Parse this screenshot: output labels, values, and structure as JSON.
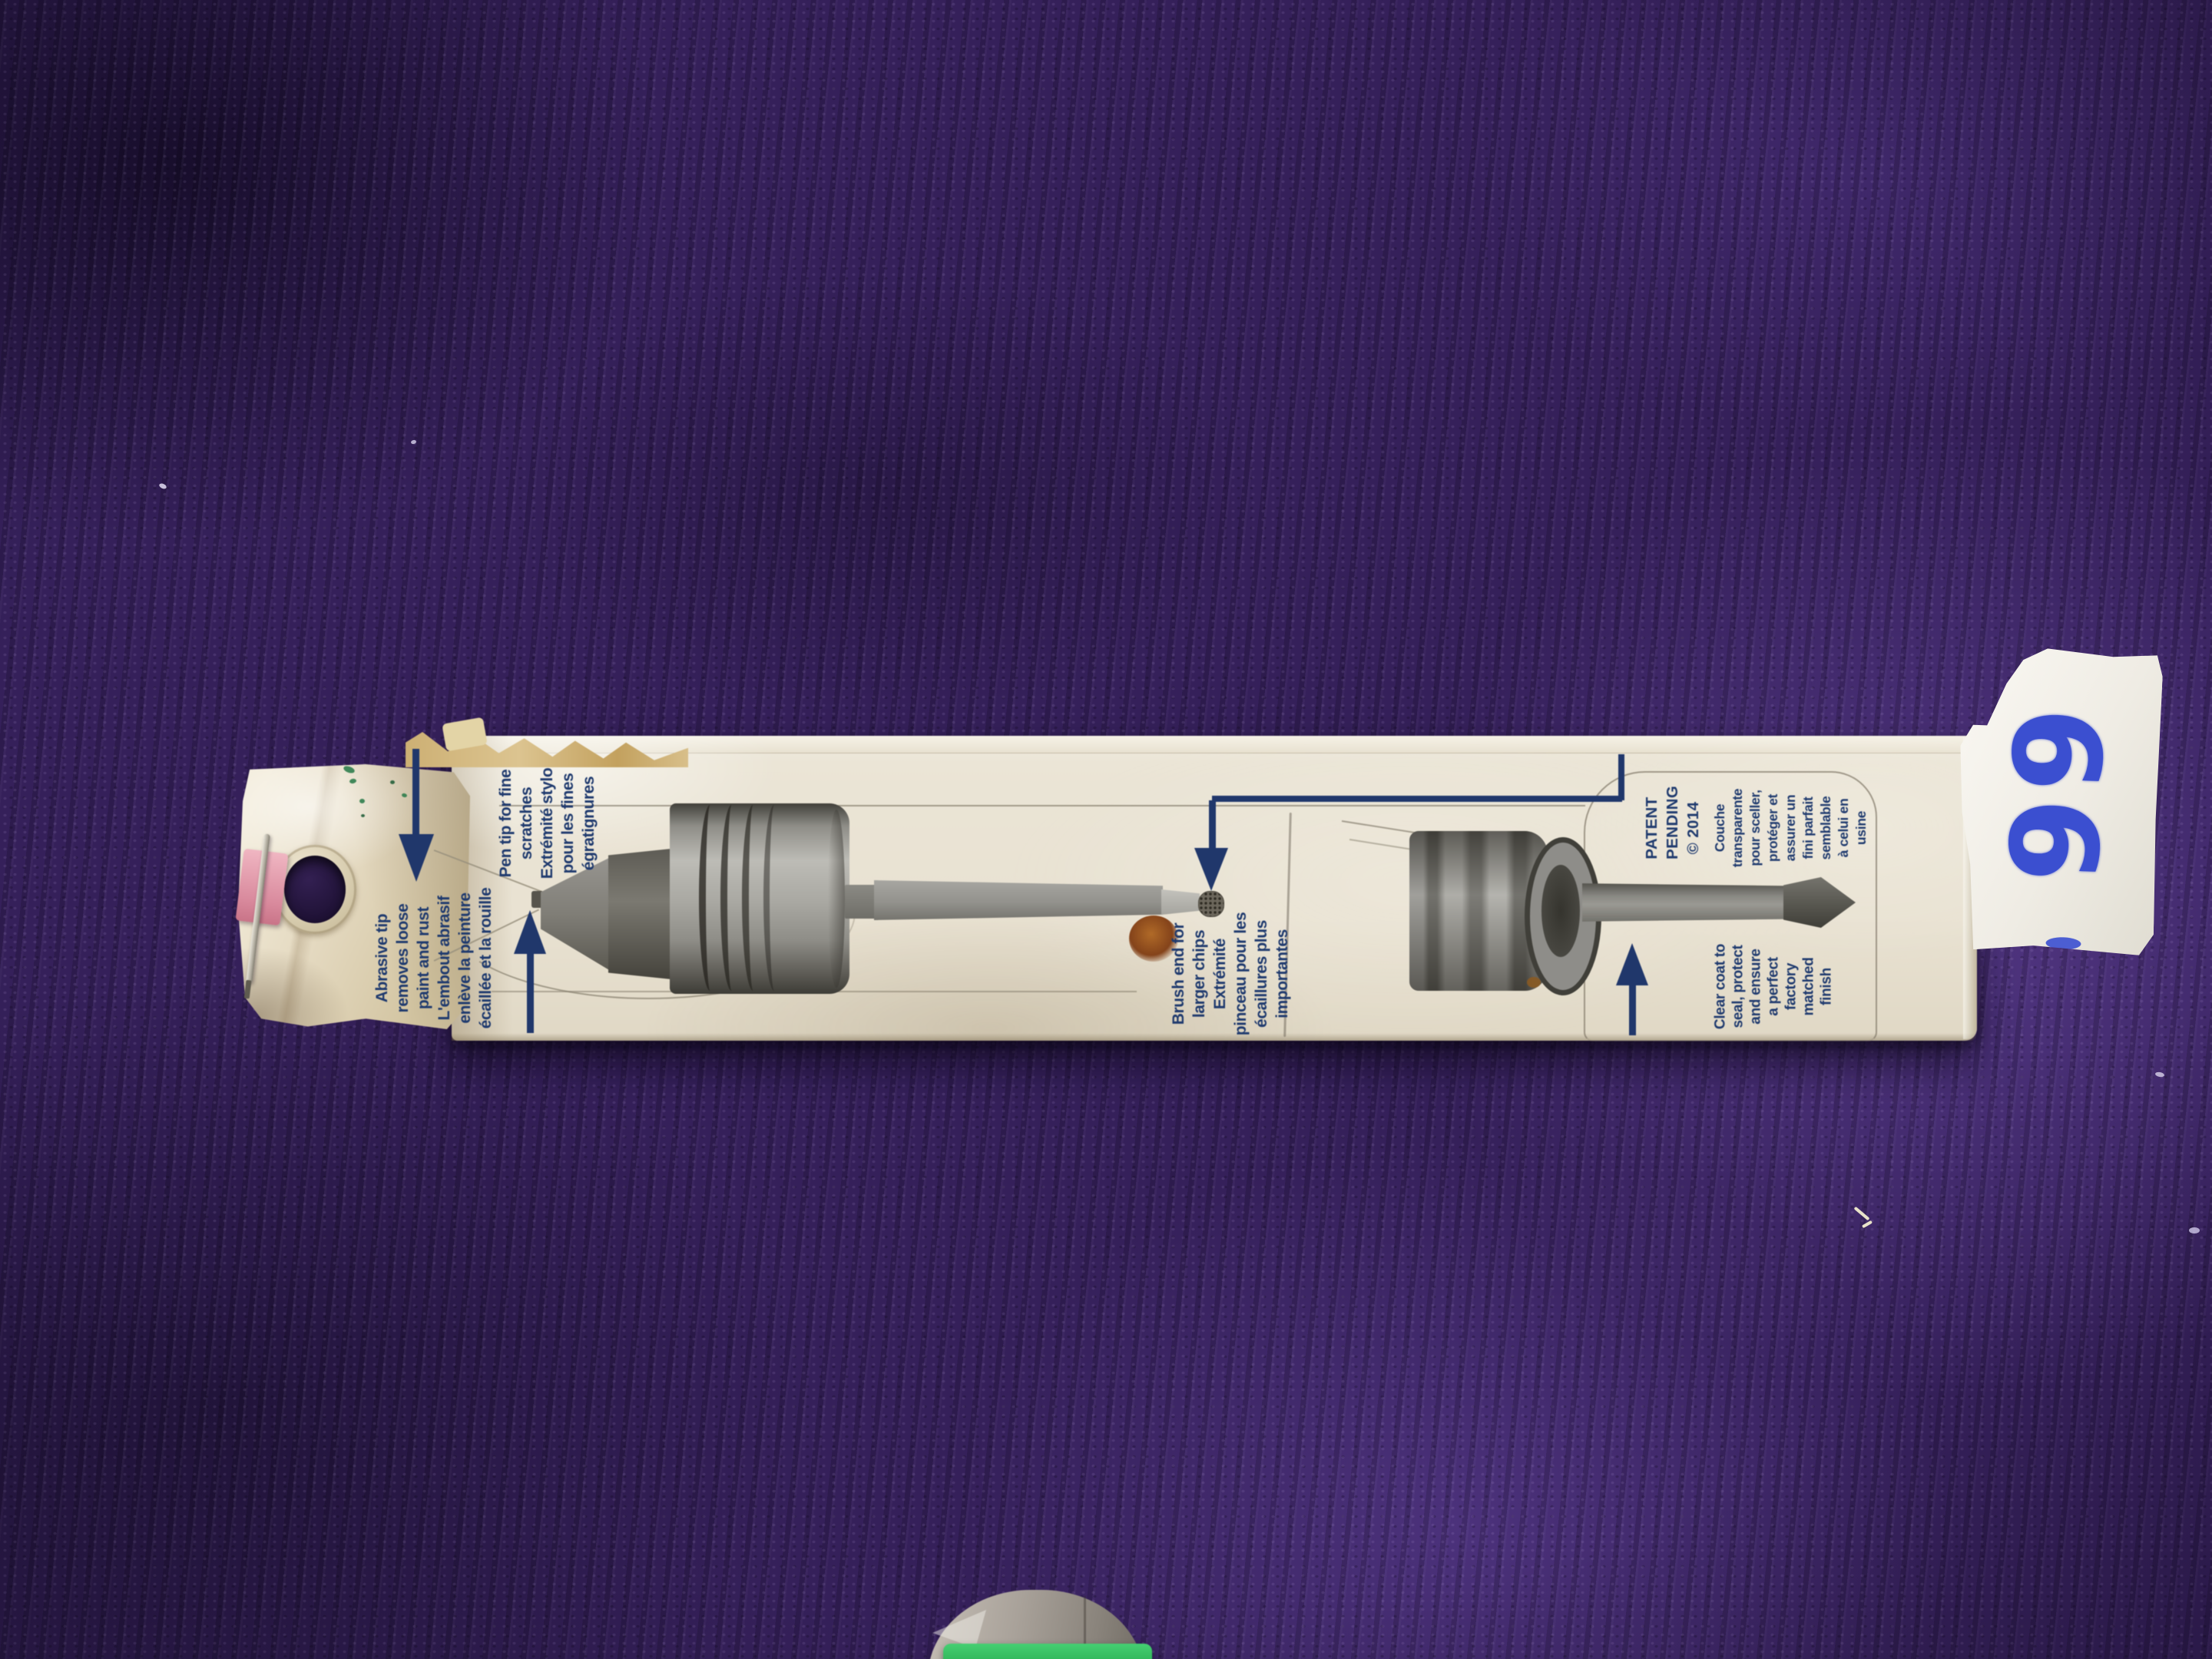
{
  "box": {
    "callouts": {
      "abrasive": {
        "en": "Abrasive tip\nremoves loose\npaint and rust",
        "fr": "L'embout abrasif\nenlève la peinture\nécaillée et la rouille"
      },
      "pen_tip": {
        "en": "Pen tip for fine\nscratches",
        "fr": "Extrémité stylo\npour les fines\négratignures"
      },
      "brush_end": {
        "en": "Brush end for\nlarger chips",
        "fr": "Extrémité\npinceau pour les\nécaillures plus\nimportantes"
      },
      "clear_coat": {
        "fr": "Couche\ntransparente\npour sceller,\nprotéger et\nassurer un\nfini parfait\nsemblable\nà celui en\nusine",
        "en": "Clear coat to\nseal, protect\nand ensure\na perfect\nfactory\nmatched\nfinish"
      }
    },
    "patent_notice": "PATENT\nPENDING\n© 2014",
    "label_color": "#1f3a6e",
    "cardboard_color": "#e9e2d2"
  },
  "price_tag": {
    "handwritten_price": "99",
    "ink_color": "#3b4fd0"
  },
  "background": {
    "carpet_color": "#35205a"
  }
}
